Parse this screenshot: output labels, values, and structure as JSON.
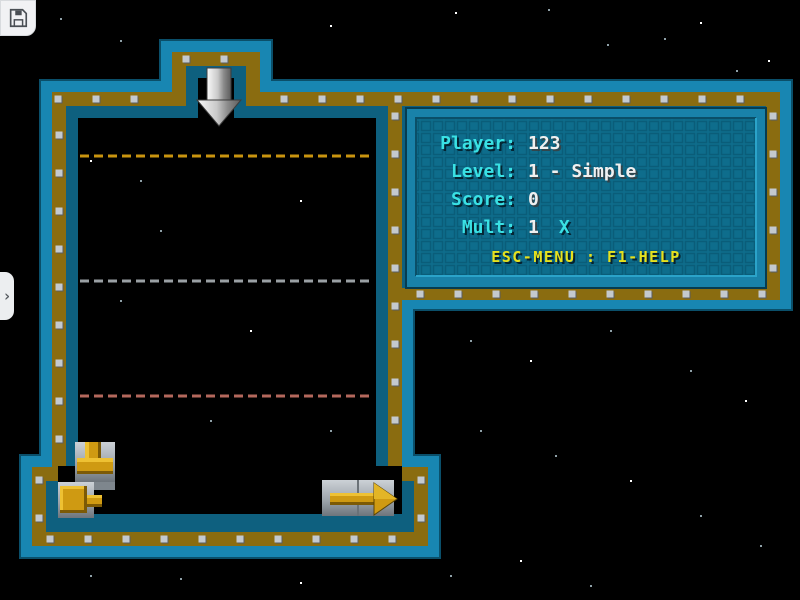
{
  "hud": {
    "rows": [
      {
        "label": "Player:",
        "value": "123"
      },
      {
        "label": "Level:",
        "value": "1 - Simple"
      },
      {
        "label": "Score:",
        "value": "0"
      },
      {
        "label": "Mult:",
        "value": "1",
        "suffix": "X"
      }
    ],
    "help": "ESC-MENU : F1-HELP"
  },
  "icons": {
    "chevron_right": "›"
  },
  "board": {
    "drop_arrow": {
      "x": 219,
      "y": 68
    },
    "guide_lines": [
      {
        "name": "gold-guide-line",
        "y": 156,
        "color": "#c9940f"
      },
      {
        "name": "gray-guide-line",
        "y": 281,
        "color": "#9aa0a4"
      },
      {
        "name": "red-guide-line",
        "y": 396,
        "color": "#b4685c"
      }
    ],
    "pieces": [
      {
        "type": "pipe-tee",
        "x": 75,
        "y": 442
      },
      {
        "type": "arrow-left",
        "x": 58,
        "y": 482
      },
      {
        "type": "arrow-right",
        "x": 322,
        "y": 480
      }
    ]
  },
  "colors": {
    "cyan": "#3ae1e4",
    "white": "#f0f0f0",
    "yellow": "#e6e11d",
    "teal_wall": "#1886b2",
    "gold_wall": "#8a6c10",
    "dark_wall": "#0e607f",
    "panel_frame": "#1982a9",
    "panel_bg": "#0e6d8c",
    "panel_grid": "#0a5d79"
  }
}
